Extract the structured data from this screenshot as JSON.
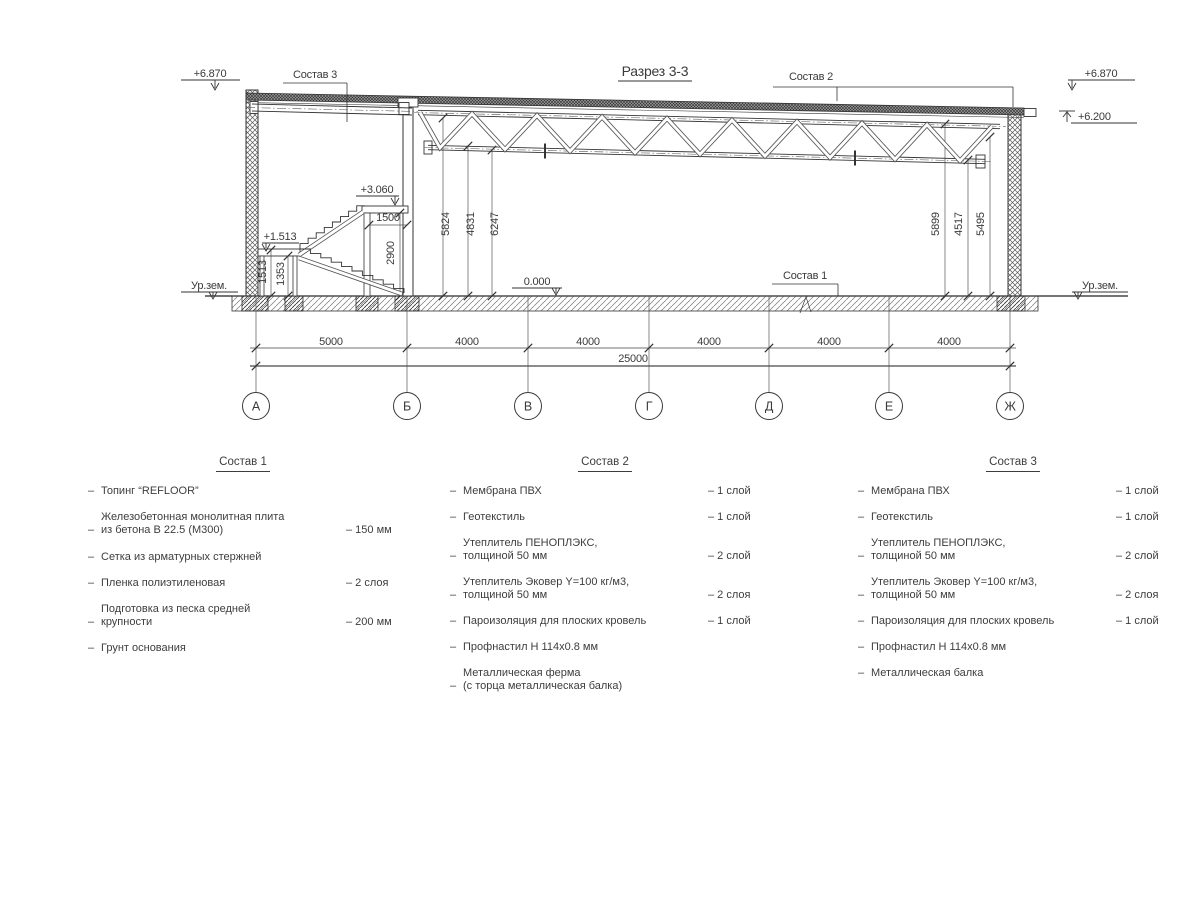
{
  "drawing": {
    "title": "Разрез 3-3",
    "marks": {
      "top_left_elev": "+6.870",
      "top_right_elev": "+6.870",
      "right_mid_elev": "+6.200",
      "floor_elev": "0.000",
      "platform_elev": "+3.060",
      "landing_elev": "+1.513",
      "ground_left": "Ур.зем.",
      "ground_right": "Ур.зем."
    },
    "callouts": {
      "c1": "Состав 1",
      "c2": "Состав 2",
      "c3": "Состав 3"
    },
    "vdims": {
      "d1513": "1513",
      "d1353": "1353",
      "d2900": "2900",
      "d1500": "1500",
      "d5824": "5824",
      "d4831": "4831",
      "d6247": "6247",
      "d5899": "5899",
      "d4517": "4517",
      "d5495": "5495"
    },
    "hdims": [
      "5000",
      "4000",
      "4000",
      "4000",
      "4000",
      "4000"
    ],
    "total_dim": "25000",
    "axes": [
      "А",
      "Б",
      "В",
      "Г",
      "Д",
      "Е",
      "Ж"
    ]
  },
  "lists": [
    {
      "title": "Состав 1",
      "items": [
        {
          "lines": [
            "Топинг “REFLOOR”"
          ],
          "value": ""
        },
        {
          "lines": [
            "Железобетонная монолитная плита",
            "из бетона В 22.5 (М300)"
          ],
          "value": "– 150 мм"
        },
        {
          "lines": [
            "Сетка из арматурных стержней"
          ],
          "value": "",
          "gap": true
        },
        {
          "lines": [
            "Пленка полиэтиленовая"
          ],
          "value": "– 2 слоя"
        },
        {
          "lines": [
            "Подготовка из песка средней",
            "крупности"
          ],
          "value": "– 200 мм"
        },
        {
          "lines": [
            "Грунт основания"
          ],
          "value": ""
        }
      ]
    },
    {
      "title": "Состав 2",
      "items": [
        {
          "lines": [
            "Мембрана ПВХ"
          ],
          "value": "– 1 слой"
        },
        {
          "lines": [
            "Геотекстиль"
          ],
          "value": "– 1 слой"
        },
        {
          "lines": [
            "Утеплитель ПЕНОПЛЭКС,",
            "толщиной 50 мм"
          ],
          "value": "– 2 слой"
        },
        {
          "lines": [
            "Утеплитель Эковер Y=100 кг/м3,",
            "толщиной 50 мм"
          ],
          "value": "– 2 слоя"
        },
        {
          "lines": [
            "Пароизоляция для плоских кровель"
          ],
          "value": "– 1 слой"
        },
        {
          "lines": [
            "Профнастил Н 114х0.8 мм"
          ],
          "value": ""
        },
        {
          "lines": [
            "Металлическая ферма",
            "(с торца металлическая балка)"
          ],
          "value": ""
        }
      ]
    },
    {
      "title": "Состав 3",
      "items": [
        {
          "lines": [
            "Мембрана ПВХ"
          ],
          "value": "– 1 слой"
        },
        {
          "lines": [
            "Геотекстиль"
          ],
          "value": "– 1 слой"
        },
        {
          "lines": [
            "Утеплитель ПЕНОПЛЭКС,",
            "толщиной 50 мм"
          ],
          "value": "– 2 слой"
        },
        {
          "lines": [
            "Утеплитель Эковер Y=100 кг/м3,",
            "толщиной 50 мм"
          ],
          "value": "– 2 слоя"
        },
        {
          "lines": [
            "Пароизоляция для плоских кровель"
          ],
          "value": "– 1 слой"
        },
        {
          "lines": [
            "Профнастил Н 114х0.8 мм"
          ],
          "value": ""
        },
        {
          "lines": [
            "Металлическая балка"
          ],
          "value": ""
        }
      ]
    }
  ]
}
